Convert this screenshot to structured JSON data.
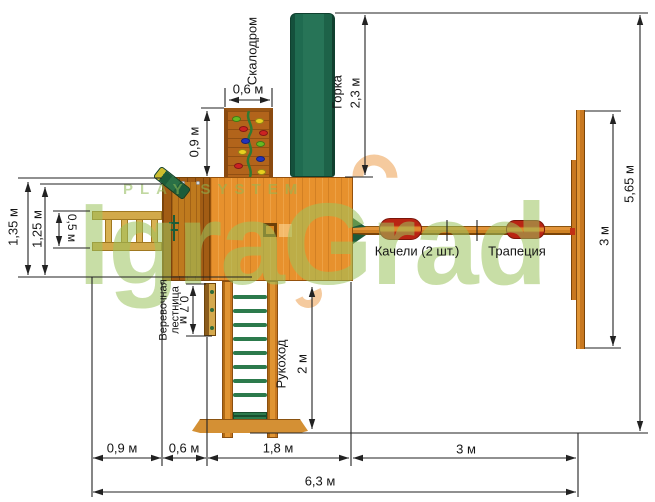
{
  "watermark": {
    "tagline": "PLAY SYSTEM",
    "brand": "IgraGrad"
  },
  "features": {
    "climbing_wall": {
      "label": "Скалодром"
    },
    "slide": {
      "label": "Горка",
      "length": "2,3 м"
    },
    "swings": {
      "label": "Качели (2 шт.)"
    },
    "trapeze": {
      "label": "Трапеция"
    },
    "rope_ladder": {
      "label": "Веревочная лестница",
      "length": "0,7 м"
    },
    "monkey_bars": {
      "label": "Рукоход",
      "length": "2 м"
    }
  },
  "dimensions": {
    "climbing_wall_width": "0,6 м",
    "climbing_wall_offset": "0,9 м",
    "platform_depth_outer": "1,35 м",
    "platform_depth_inner": "1,25 м",
    "ladder_width": "0,5 м",
    "swing_frame_span": "3 м",
    "total_depth": "5,65 м",
    "bottom_segments": [
      "0,9 м",
      "0,6 м",
      "1,8 м",
      "3 м"
    ],
    "total_width": "6,3 м"
  },
  "colors": {
    "wood_main": "#e7912d",
    "wood_dark": "#a25c14",
    "slide_green": "#1f6b50",
    "seat_red": "#c02414",
    "rung_green": "#2c7a4c",
    "watermark_green": "#9cc45e",
    "dimension_line": "#222222"
  }
}
